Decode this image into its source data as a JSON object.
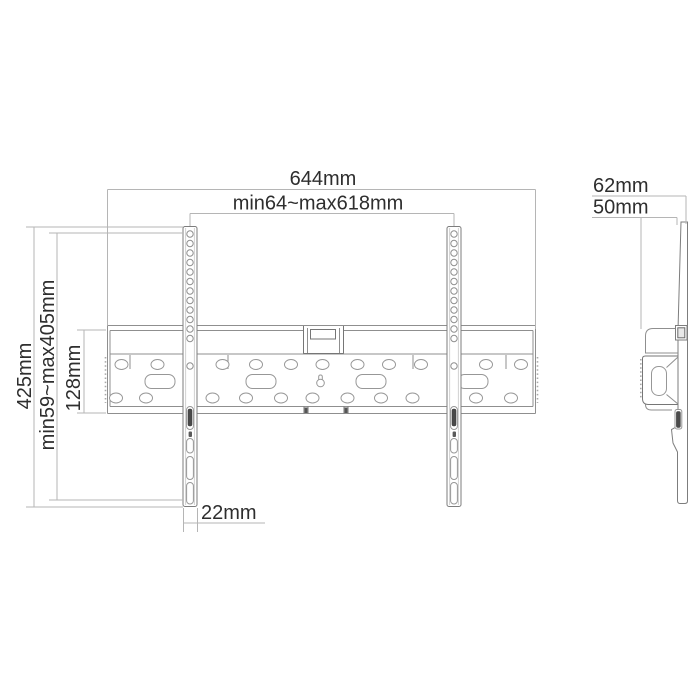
{
  "drawing": {
    "title": "TV wall mount dimensional line drawing",
    "views": {
      "front": {
        "name": "front-view",
        "dimensions": {
          "total_width": "644mm",
          "mount_range": "min64~max618mm",
          "total_height": "425mm",
          "height_range": "min59~max405mm",
          "plate_height": "128mm",
          "arm_width": "22mm"
        }
      },
      "side": {
        "name": "side-view",
        "dimensions": {
          "depth_total": "62mm",
          "depth_plate": "50mm"
        }
      }
    },
    "colors": {
      "background": "#ffffff",
      "dimension_lines": "#b5b5b5",
      "drawing_lines": "#8f8f8f",
      "text": "#2e2e2e",
      "screw_fill": "#4a4a4a"
    }
  }
}
